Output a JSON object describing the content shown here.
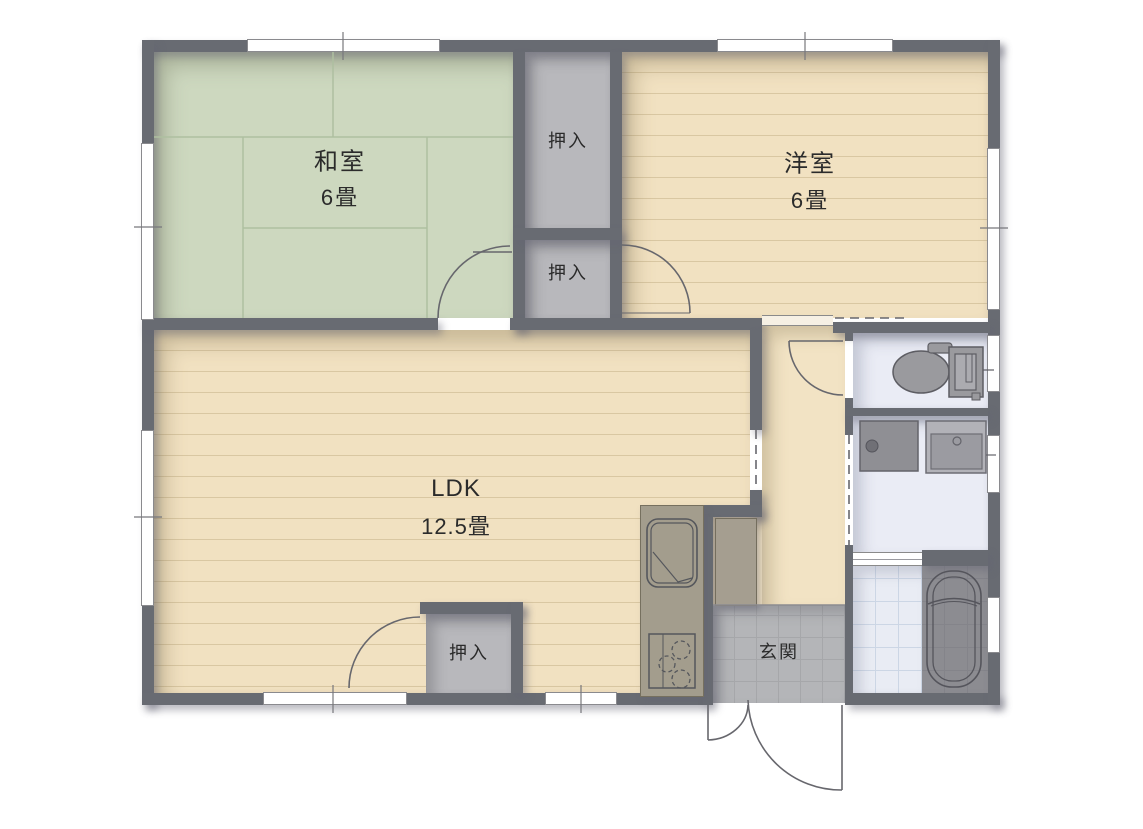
{
  "floorplan": {
    "title": "2DK apartment floor plan",
    "rooms": {
      "washitsu": {
        "label": "和室",
        "size": "6畳"
      },
      "yoshitsu": {
        "label": "洋室",
        "size": "6畳"
      },
      "ldk": {
        "label": "LDK",
        "size": "12.5畳"
      },
      "closet1": {
        "label": "押入"
      },
      "closet2": {
        "label": "押入"
      },
      "closet3": {
        "label": "押入"
      },
      "genkan": {
        "label": "玄関"
      }
    },
    "fixtures": [
      "toilet-icon",
      "vanity-sink-icon",
      "washing-machine-pan-icon",
      "bathtub-icon",
      "kitchen-sink-icon",
      "stove-icon",
      "shoe-cabinet",
      "door-swing-arc",
      "window-marker"
    ],
    "colors": {
      "wall": "#686b72",
      "tatami": "#cdd8bf",
      "wood_floor": "#f1e1c1",
      "closet": "#b8b8bc",
      "white_room_floor": "#eaecf5",
      "genkan_tile": "#b4b5b8",
      "bath_tub_zone": "#8c8c91",
      "line": "#67676d"
    }
  }
}
